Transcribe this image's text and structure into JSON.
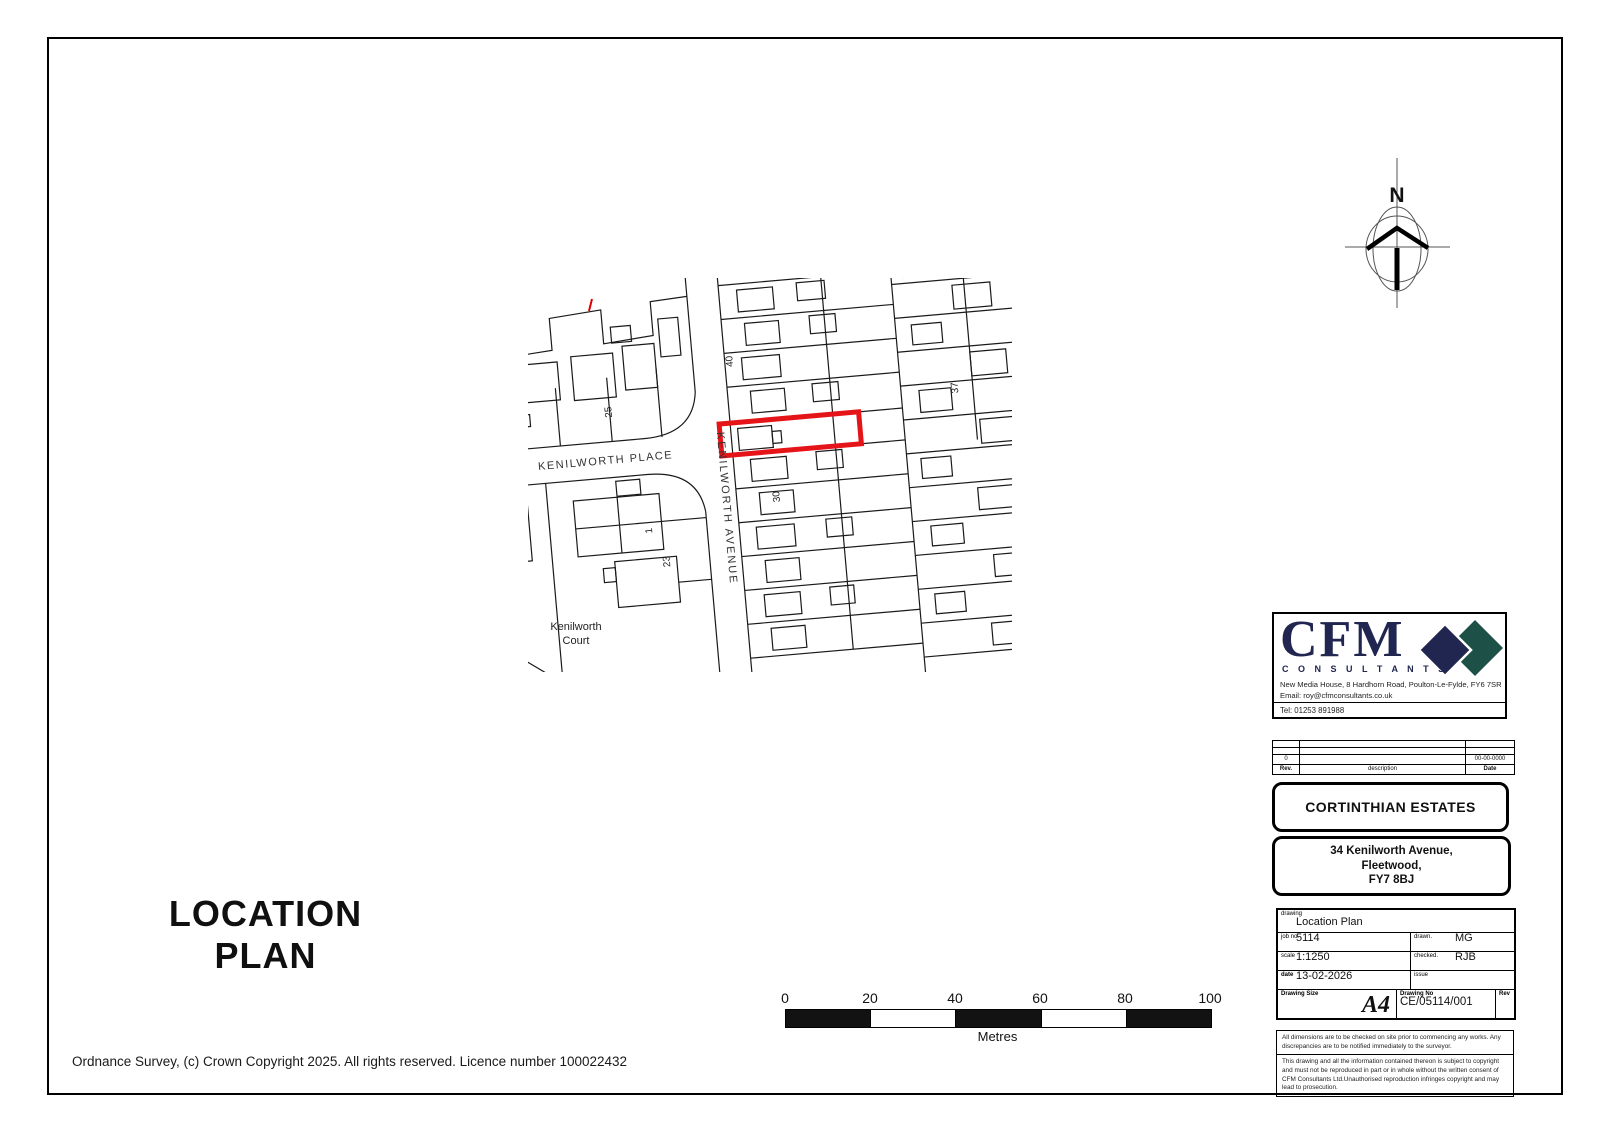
{
  "title_text": {
    "line1": "LOCATION",
    "line2": "PLAN"
  },
  "footer": {
    "copyright": "Ordnance Survey, (c) Crown Copyright 2025. All rights reserved. Licence number 100022432"
  },
  "north_arrow": {
    "label": "N"
  },
  "map": {
    "streets": {
      "avenue": "KENILWORTH AVENUE",
      "place": "KENILWORTH PLACE",
      "court_line1": "Kenilworth",
      "court_line2": "Court"
    },
    "numbers": {
      "n2": "2",
      "n25": "25",
      "n40": "40",
      "n37": "37",
      "n30": "30",
      "n23": "23",
      "n1": "1"
    },
    "site_outline_color": "#e41418"
  },
  "scale_bar": {
    "ticks": [
      "0",
      "20",
      "40",
      "60",
      "80",
      "100"
    ],
    "unit": "Metres"
  },
  "logo": {
    "name": "CFM",
    "tagline": "C O N S U L T A N T S",
    "address": "New Media House,  8 Hardhorn Road,  Poulton-Le-Fylde,  FY6 7SR",
    "email": "Email: roy@cfmconsultants.co.uk",
    "tel": "Tel: 01253 891988",
    "navy": "#20264f",
    "teal": "#1d5148"
  },
  "revisions": {
    "col_rev": "Rev.",
    "col_description": "description",
    "col_date": "Date",
    "rows": [
      {
        "rev": "0",
        "description": "",
        "date": "00-00-0000"
      }
    ]
  },
  "client": {
    "name": "CORTINTHIAN ESTATES"
  },
  "site": {
    "line1": "34 Kenilworth Avenue,",
    "line2": "Fleetwood,",
    "line3": "FY7 8BJ"
  },
  "info": {
    "drawing_label": "drawing",
    "drawing": "Location Plan",
    "job_label": "job no.",
    "job": "5114",
    "drawn_label": "drawn.",
    "drawn": "MG",
    "scale_label": "scale",
    "scale": "1:1250",
    "checked_label": "checked.",
    "checked": "RJB",
    "date_label": "date",
    "date": "13-02-2026",
    "issue_label": "issue",
    "issue": "",
    "size_label": "Drawing Size",
    "size": "A4",
    "no_label": "Drawing No",
    "no": "CE/05114/001",
    "rev_label": "Rev"
  },
  "disclaimers": {
    "line1": "All dimensions are to be checked on site prior to commencing any works. Any discrepancies are to be notified immediately to the surveyor.",
    "line2": "This drawing and all the information contained thereon is subject to copyright and must not be reproduced in part or in whole without the written consent of CFM Consultants Ltd.Unauthorised reproduction infringes copyright and may lead to prosecution."
  }
}
